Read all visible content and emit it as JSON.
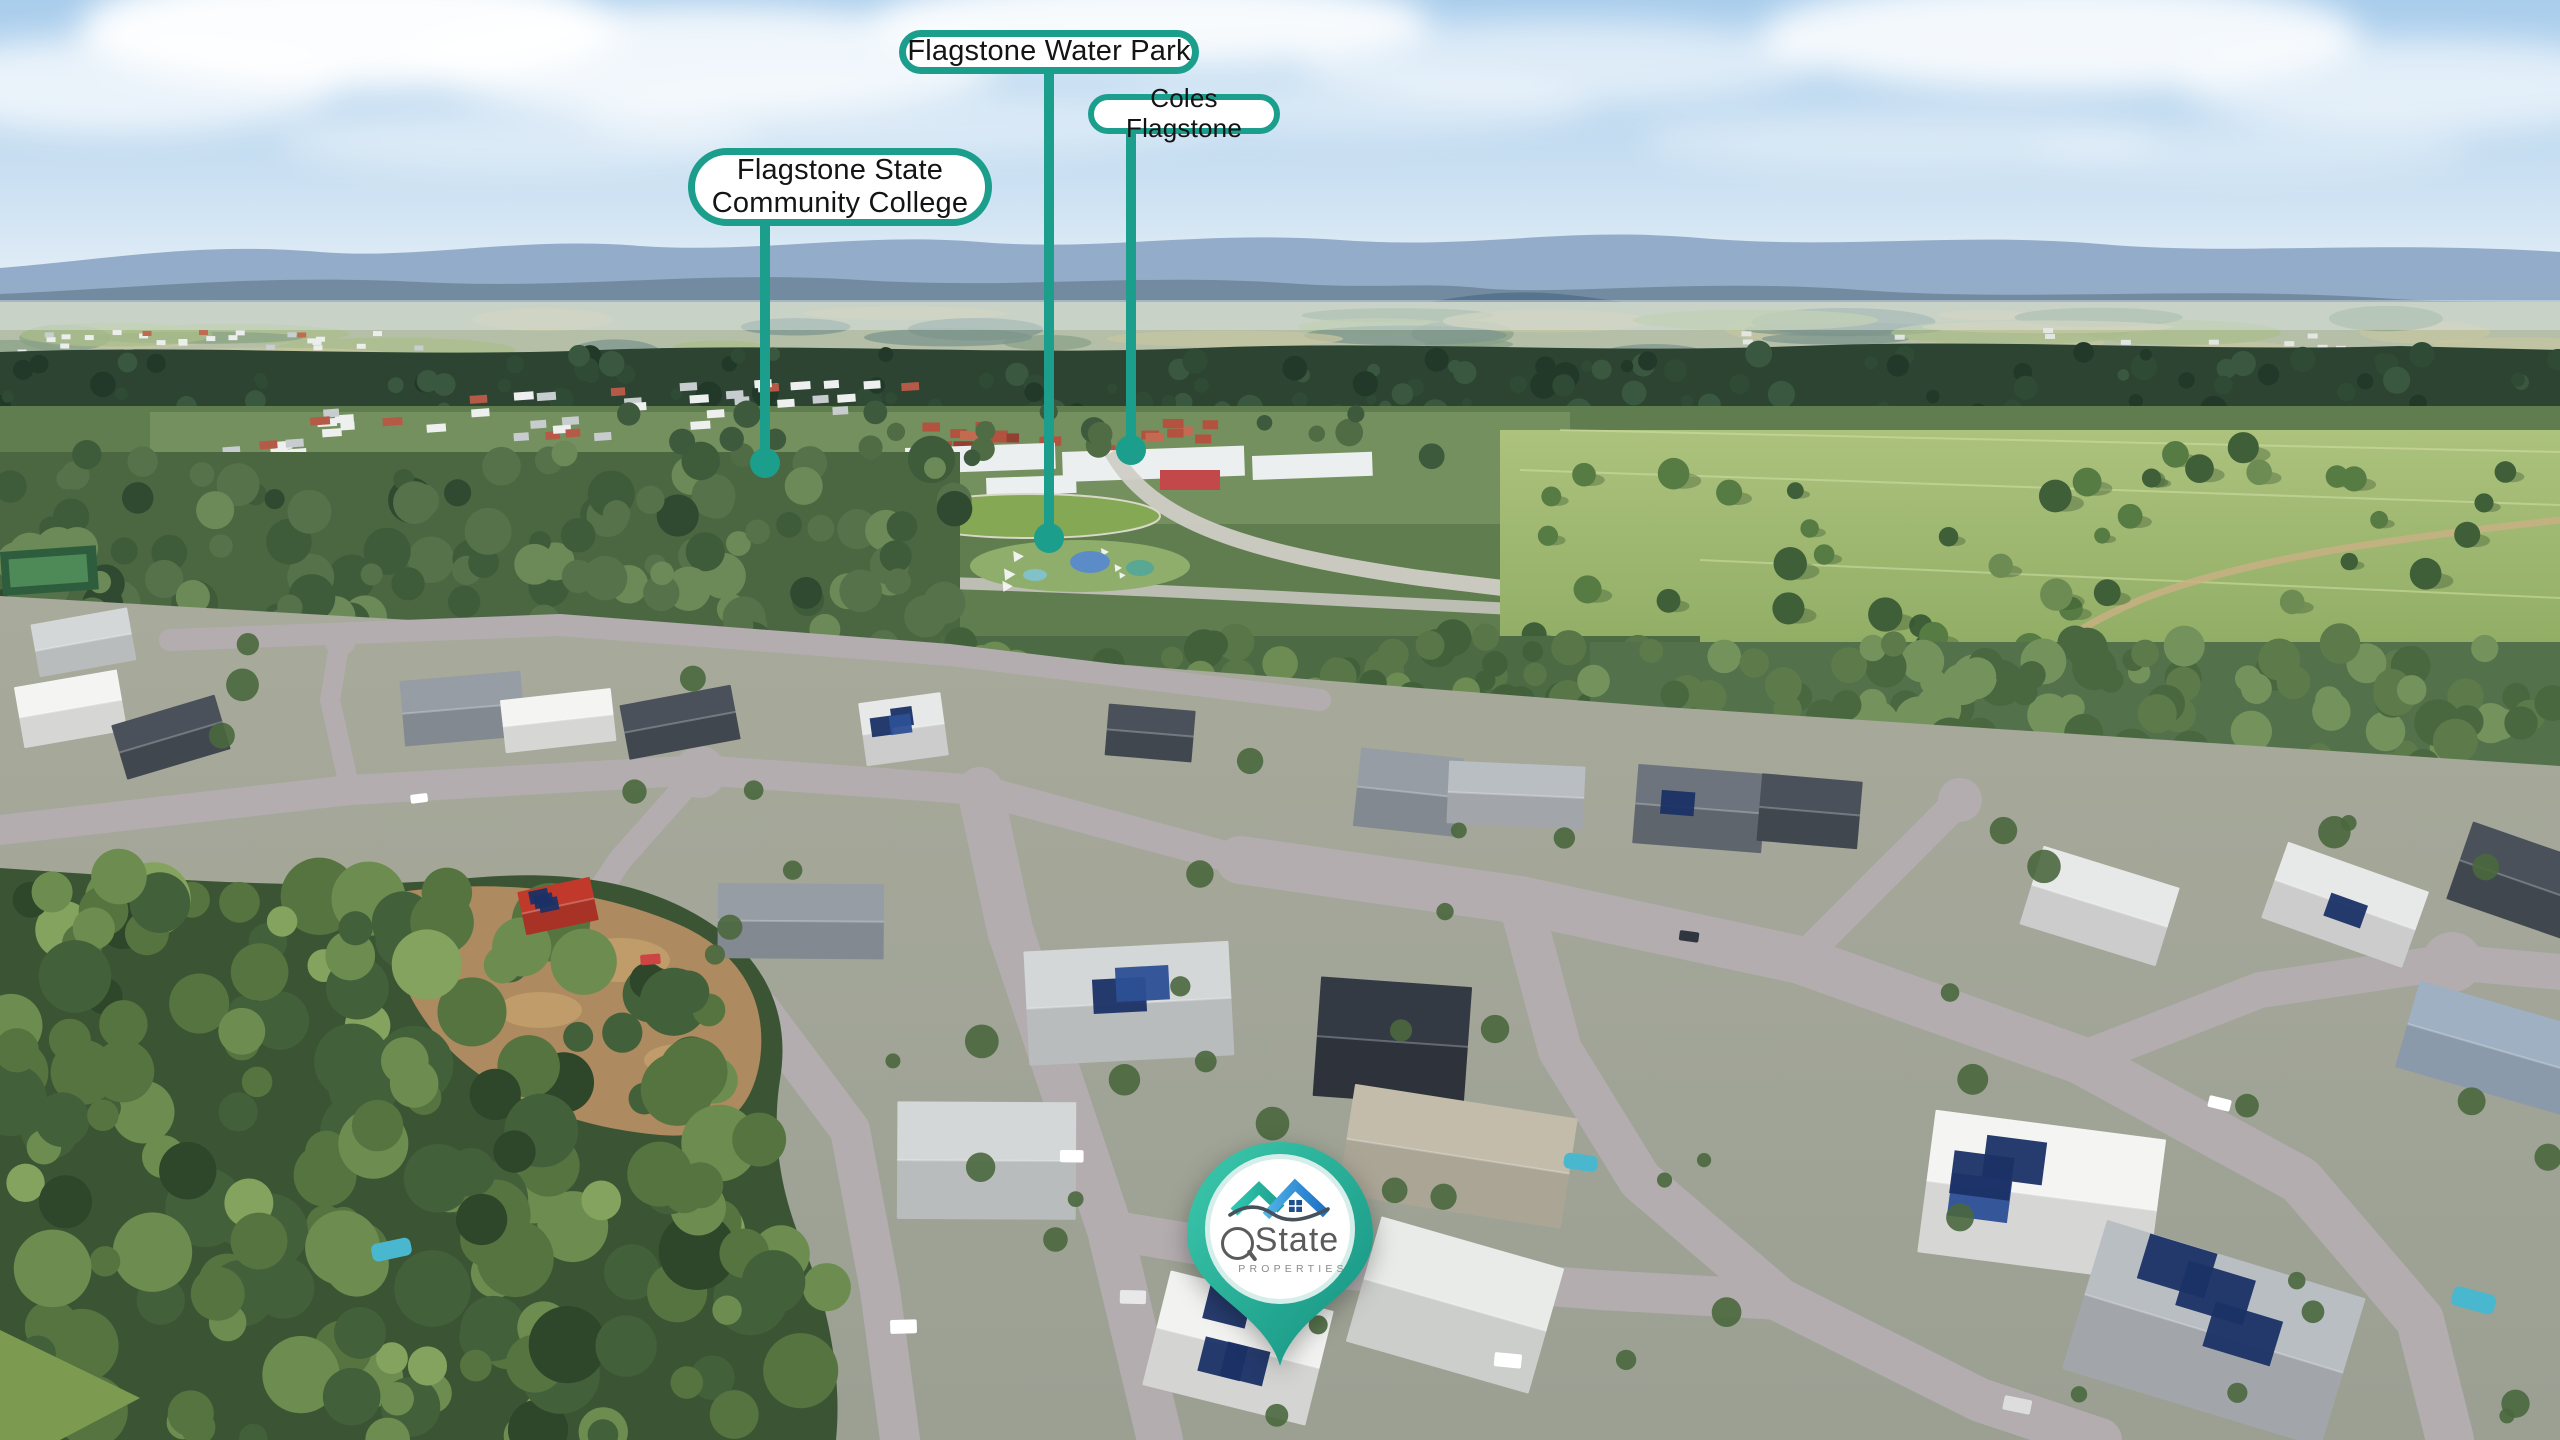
{
  "colors": {
    "accent_teal": "#1b9e8c",
    "pin_grad_top": "#38c6aa",
    "pin_grad_bottom": "#149180",
    "label_bg": "#ffffff",
    "label_text": "#141414",
    "solar_panel": "#1b3266",
    "road": "#b2acb0",
    "forest_dark": "#3b5534",
    "sky_top": "#a9cdec"
  },
  "callouts": [
    {
      "id": "water-park",
      "label": "Flagstone Water Park"
    },
    {
      "id": "coles",
      "label": "Coles Flagstone"
    },
    {
      "id": "college",
      "lines": [
        "Flagstone State",
        "Community College"
      ]
    }
  ],
  "brand_pin": {
    "q": "Q",
    "state": "State",
    "subtitle": "PROPERTIES"
  }
}
